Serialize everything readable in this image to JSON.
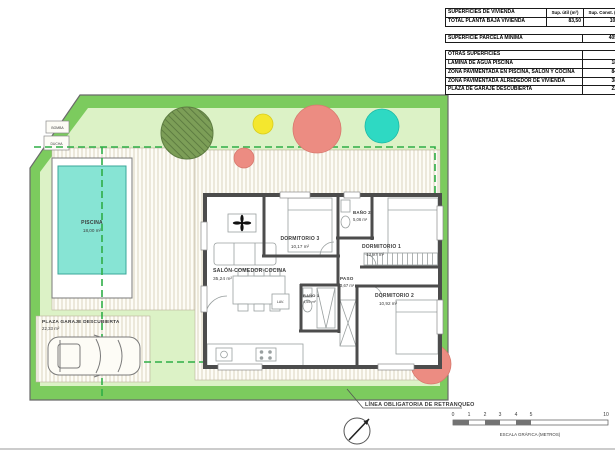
{
  "table": {
    "header": {
      "title": "SUPERFICIES DE VIVIENDA",
      "util": "Sup. útil (m²)",
      "const": "Sup. Const. (m²)"
    },
    "total": {
      "label": "TOTAL PLANTA BAJA VIVIENDA",
      "util": "83,50",
      "const": "101,09"
    },
    "parcela": {
      "label": "SUPERFICIE PARCELA MÍNIMA",
      "value": "405,00"
    },
    "otras_title": "OTRAS SUPERFICIES",
    "otras": [
      {
        "label": "LÁMINA DE AGUA PISCINA",
        "value": "18,00"
      },
      {
        "label": "ZONA PAVIMENTADA EN PISCINA, SALÓN Y COCINA",
        "value": "84,01"
      },
      {
        "label": "ZONA PAVIMENTADA ALREDEDOR DE VIVIENDA",
        "value": "38,59"
      },
      {
        "label": "PLAZA DE GARAJE DESCUBIERTA",
        "value": "22,19"
      }
    ]
  },
  "rooms": {
    "salon": {
      "name": "SALÓN-COMEDOR-COCINA",
      "area": "35,24 m²"
    },
    "dormitorio1": {
      "name": "DORMITORIO 1",
      "area": "13,97 m²"
    },
    "dormitorio2": {
      "name": "DORMITORIO 2",
      "area": "10,92 m²"
    },
    "dormitorio3": {
      "name": "DORMITORIO 3",
      "area": "10,17 m²"
    },
    "bano1": {
      "name": "BAÑO 1",
      "area": "4,55 m²"
    },
    "bano2": {
      "name": "BAÑO 2",
      "area": "5,06 m²"
    },
    "paso": {
      "name": "PASO",
      "area": "3,67 m²"
    },
    "piscina": {
      "name": "PISCINA",
      "area": "18,00 m²"
    },
    "garaje": {
      "name": "PLAZA GARAJE DESCUBIERTA",
      "area": "22,33 m²"
    },
    "lav": "LAV.",
    "bomba": "BOMBA",
    "ducha": "DUCHA"
  },
  "annotations": {
    "retranqueo": "LÍNEA OBLIGATORIA DE RETRANQUEO",
    "escala": "ESCALA GRÁFICA (METROS)",
    "ticks": [
      "0",
      "1",
      "2",
      "3",
      "4",
      "5",
      "10"
    ]
  },
  "colors": {
    "lawn_border": "#7ccb5e",
    "lawn": "#dcf2c6",
    "pool": "#87e4d4",
    "setback": "#2fae47",
    "tree_olive": "#7c9e57",
    "tree_yellow": "#f4e72e",
    "tree_salmon": "#ec8c82",
    "tree_teal": "#2ed9c3",
    "highlight_row": "#d6eaf2"
  }
}
